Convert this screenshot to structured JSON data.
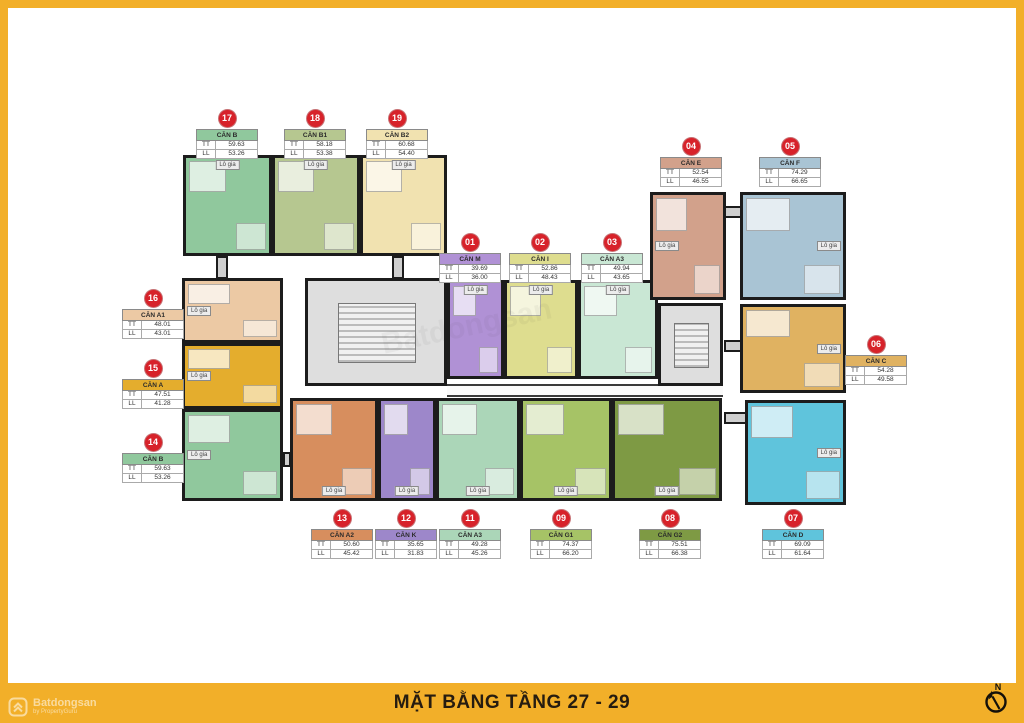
{
  "page": {
    "title": "MẶT BẰNG TẦNG 27 - 29"
  },
  "branding": {
    "brand": "Batdongsan",
    "byline": "by PropertyGuru",
    "plan_watermark": "Batdongsan"
  },
  "compass": {
    "north": "N"
  },
  "labels": {
    "tt": "TT",
    "ll": "LL",
    "lo_gia": "Lô gia"
  },
  "units_order": [
    "17",
    "18",
    "19",
    "04",
    "05",
    "01",
    "02",
    "03",
    "16",
    "15",
    "14",
    "06",
    "13",
    "12",
    "11",
    "09",
    "08",
    "07"
  ],
  "units": {
    "01": {
      "num": "01",
      "name": "CĂN M",
      "tt": "39.69",
      "ll": "36.00",
      "color": "#b091d5"
    },
    "02": {
      "num": "02",
      "name": "CĂN I",
      "tt": "52.86",
      "ll": "48.43",
      "color": "#dedd8f"
    },
    "03": {
      "num": "03",
      "name": "CĂN A3",
      "tt": "49.94",
      "ll": "43.65",
      "color": "#c9e7d4"
    },
    "04": {
      "num": "04",
      "name": "CĂN E",
      "tt": "52.54",
      "ll": "46.55",
      "color": "#d2a18b"
    },
    "05": {
      "num": "05",
      "name": "CĂN F",
      "tt": "74.29",
      "ll": "66.65",
      "color": "#a9c4d4"
    },
    "06": {
      "num": "06",
      "name": "CĂN C",
      "tt": "54.28",
      "ll": "49.58",
      "color": "#e0b261"
    },
    "07": {
      "num": "07",
      "name": "CĂN D",
      "tt": "69.09",
      "ll": "61.64",
      "color": "#5fc4dc"
    },
    "08": {
      "num": "08",
      "name": "CĂN G2",
      "tt": "75.51",
      "ll": "66.38",
      "color": "#7e9a44"
    },
    "09": {
      "num": "09",
      "name": "CĂN G1",
      "tt": "74.37",
      "ll": "66.20",
      "color": "#a6c366"
    },
    "11": {
      "num": "11",
      "name": "CĂN A3",
      "tt": "49.28",
      "ll": "45.26",
      "color": "#abd6b8"
    },
    "12": {
      "num": "12",
      "name": "CĂN K",
      "tt": "35.65",
      "ll": "31.83",
      "color": "#9d87ca"
    },
    "13": {
      "num": "13",
      "name": "CĂN A2",
      "tt": "50.60",
      "ll": "45.42",
      "color": "#d78e5e"
    },
    "14": {
      "num": "14",
      "name": "CĂN B",
      "tt": "59.63",
      "ll": "53.26",
      "color": "#90c89d"
    },
    "15": {
      "num": "15",
      "name": "CĂN A",
      "tt": "47.51",
      "ll": "41.28",
      "color": "#e4ad2d"
    },
    "16": {
      "num": "16",
      "name": "CĂN A1",
      "tt": "48.01",
      "ll": "43.01",
      "color": "#ecc9a4"
    },
    "17": {
      "num": "17",
      "name": "CĂN B",
      "tt": "59.63",
      "ll": "53.26",
      "color": "#90c89d"
    },
    "18": {
      "num": "18",
      "name": "CĂN B1",
      "tt": "58.18",
      "ll": "53.38",
      "color": "#b6c790"
    },
    "19": {
      "num": "19",
      "name": "CĂN B2",
      "tt": "60.68",
      "ll": "54.40",
      "color": "#f1e2b0"
    }
  }
}
